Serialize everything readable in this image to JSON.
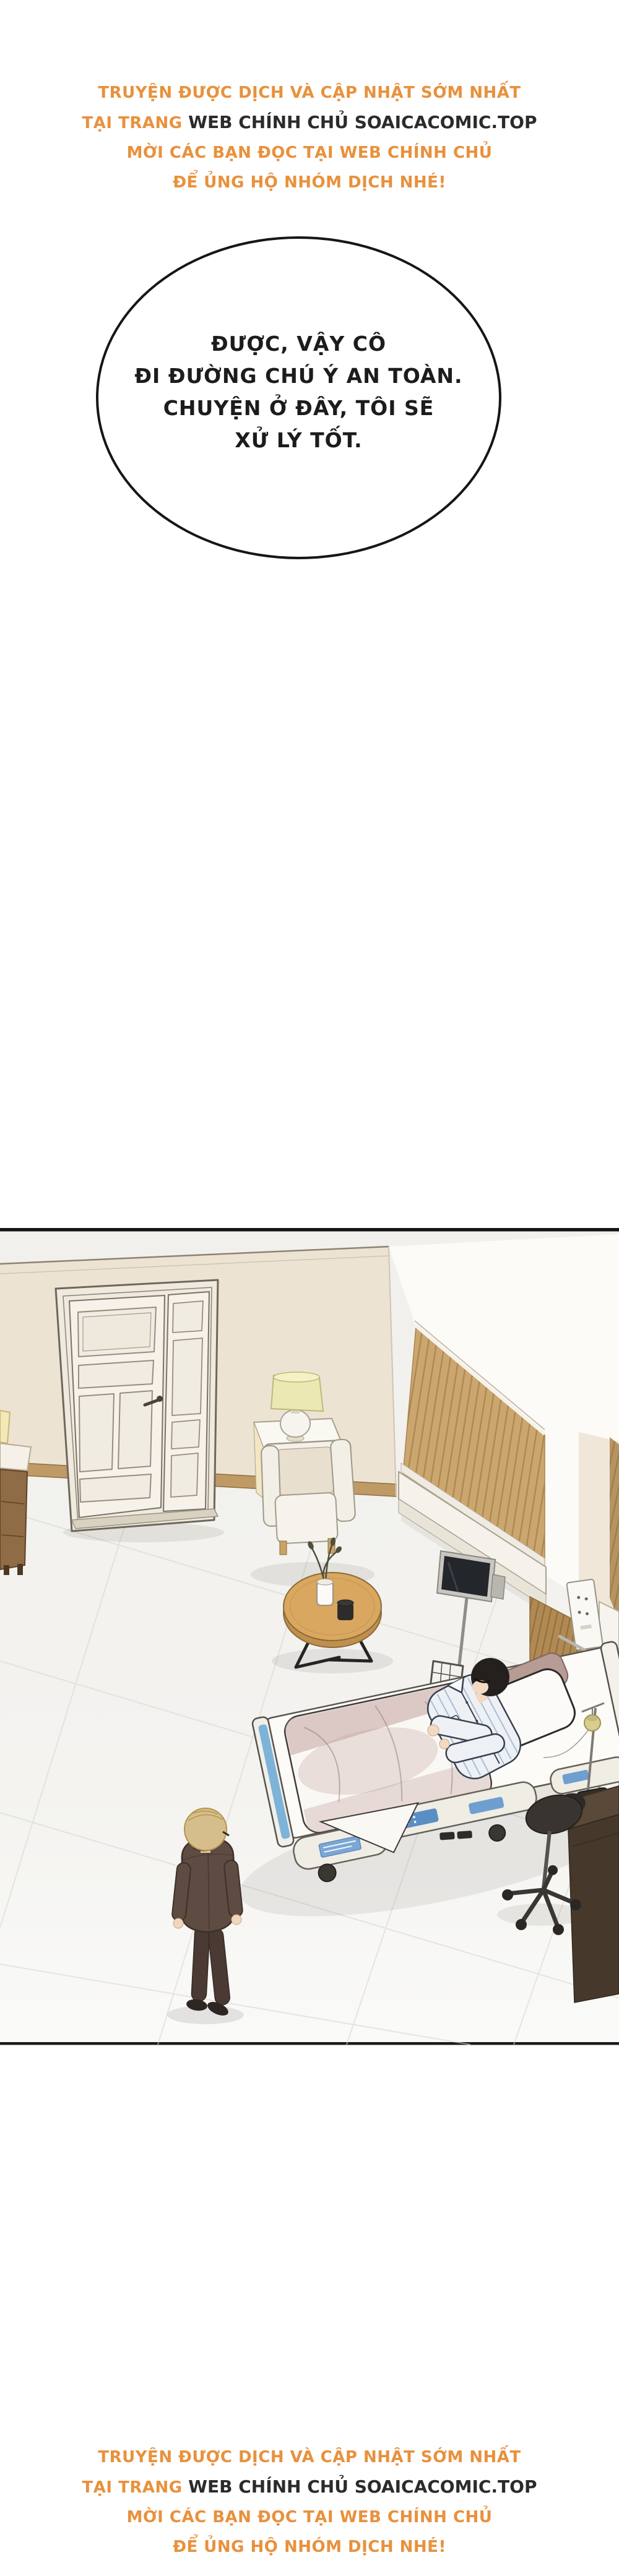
{
  "banner": {
    "line1": "TRUYỆN ĐƯỢC DỊCH VÀ CẬP NHẬT SỚM NHẤT",
    "line2_prefix": "TẠI TRANG",
    "line2_site": "WEB CHÍNH CHỦ SOAICACOMIC.TOP",
    "line3": "MỜI CÁC BẠN ĐỌC TẠI WEB CHÍNH CHỦ",
    "line4": "ĐỂ ỦNG HỘ NHÓM DỊCH NHÉ!"
  },
  "bubble": {
    "lines": [
      "ĐƯỢC, VẬY CÔ",
      "ĐI ĐƯỜNG CHÚ Ý AN TOÀN.",
      "CHUYỆN Ở ĐÂY, TÔI SẼ",
      "XỬ LÝ TỐT."
    ]
  },
  "colors": {
    "accent_orange": "#E8913C",
    "ink": "#2B2B2B",
    "wall_beige": "#EDE3D3",
    "baseboard": "#C09A64",
    "wood_slat": "#CBA76F",
    "wood_dark": "#B08A52",
    "floor": "#F3F2EF",
    "tile_line": "#DBD7D0",
    "bed_cream": "#F0EDE5",
    "panel_blue": "#5B8FC4",
    "foot_blue": "#7DB3D8",
    "blanket_mauve": "#C2A39D",
    "pajama_stripe": "#9FB3CC",
    "hair_blond": "#D6BE8C",
    "hair_black": "#23201E",
    "suit_brown": "#5E4B42",
    "table_wood": "#D9A75F",
    "lamp_shade": "#ECE8B4"
  }
}
